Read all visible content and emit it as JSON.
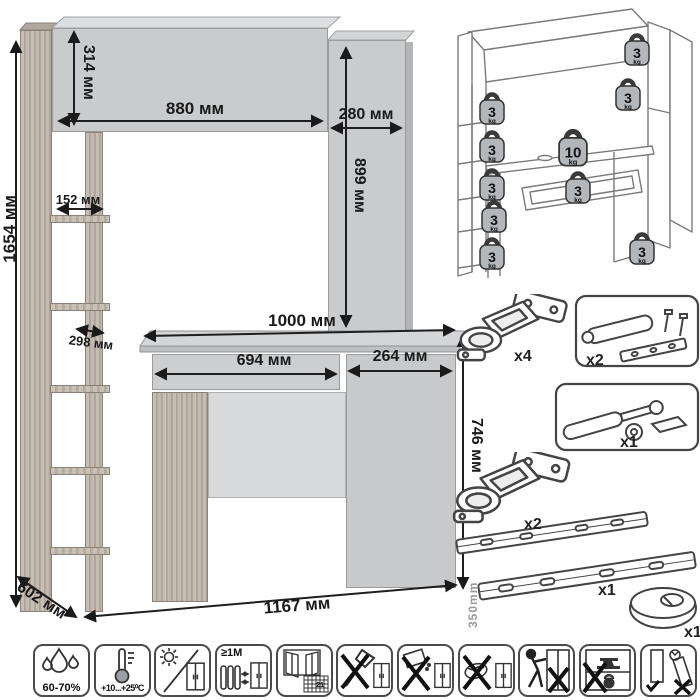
{
  "diagram": {
    "dimensions": {
      "total_height": "1654 мм",
      "hutch_height": "314 мм",
      "hutch_width": "880 мм",
      "top_cabinet_width": "280 мм",
      "top_cabinet_height": "899 мм",
      "shelf_width": "152 мм",
      "shelf_depth": "298 мм",
      "desktop_width": "1000 мм",
      "drawer_width": "694 мм",
      "pedestal_width": "264 мм",
      "desk_height": "746 мм",
      "depth": "602 мм",
      "total_width": "1167 мм"
    },
    "load_diagram": {
      "badges": [
        {
          "value": "3",
          "unit": "kg",
          "location": "left-shelf-1"
        },
        {
          "value": "3",
          "unit": "kg",
          "location": "left-shelf-2"
        },
        {
          "value": "3",
          "unit": "kg",
          "location": "left-shelf-3"
        },
        {
          "value": "3",
          "unit": "kg",
          "location": "left-shelf-4"
        },
        {
          "value": "3",
          "unit": "kg",
          "location": "left-shelf-5"
        },
        {
          "value": "3",
          "unit": "kg",
          "location": "top-right-shelf"
        },
        {
          "value": "3",
          "unit": "kg",
          "location": "right-shelf"
        },
        {
          "value": "10",
          "unit": "kg",
          "location": "desktop"
        },
        {
          "value": "3",
          "unit": "kg",
          "location": "drawer"
        },
        {
          "value": "3",
          "unit": "kg",
          "location": "pedestal"
        }
      ]
    },
    "hardware": {
      "items": [
        {
          "name": "hinge",
          "label": "x4"
        },
        {
          "name": "push-latch-kit",
          "label": "x2"
        },
        {
          "name": "gas-lift",
          "label": "x1"
        },
        {
          "name": "hinge",
          "label": "x2"
        },
        {
          "name": "drawer-slides",
          "label": "x1",
          "length": "350mm"
        },
        {
          "name": "cable-grommet",
          "label": "x1"
        }
      ]
    },
    "care_icons": [
      {
        "name": "humidity",
        "label": "60-70%"
      },
      {
        "name": "temperature",
        "label": "+10...+25⁰C"
      },
      {
        "name": "no-direct-sunlight",
        "label": ""
      },
      {
        "name": "heater-distance",
        "label": "≥1М"
      },
      {
        "name": "ventilation-calendar",
        "label": "21"
      },
      {
        "name": "no-sharp-tools",
        "label": ""
      },
      {
        "name": "no-abrasives",
        "label": ""
      },
      {
        "name": "no-wet-cleaning",
        "label": ""
      },
      {
        "name": "no-dragging",
        "label": ""
      },
      {
        "name": "no-overloading",
        "label": ""
      },
      {
        "name": "transport-upright",
        "label": ""
      }
    ]
  }
}
